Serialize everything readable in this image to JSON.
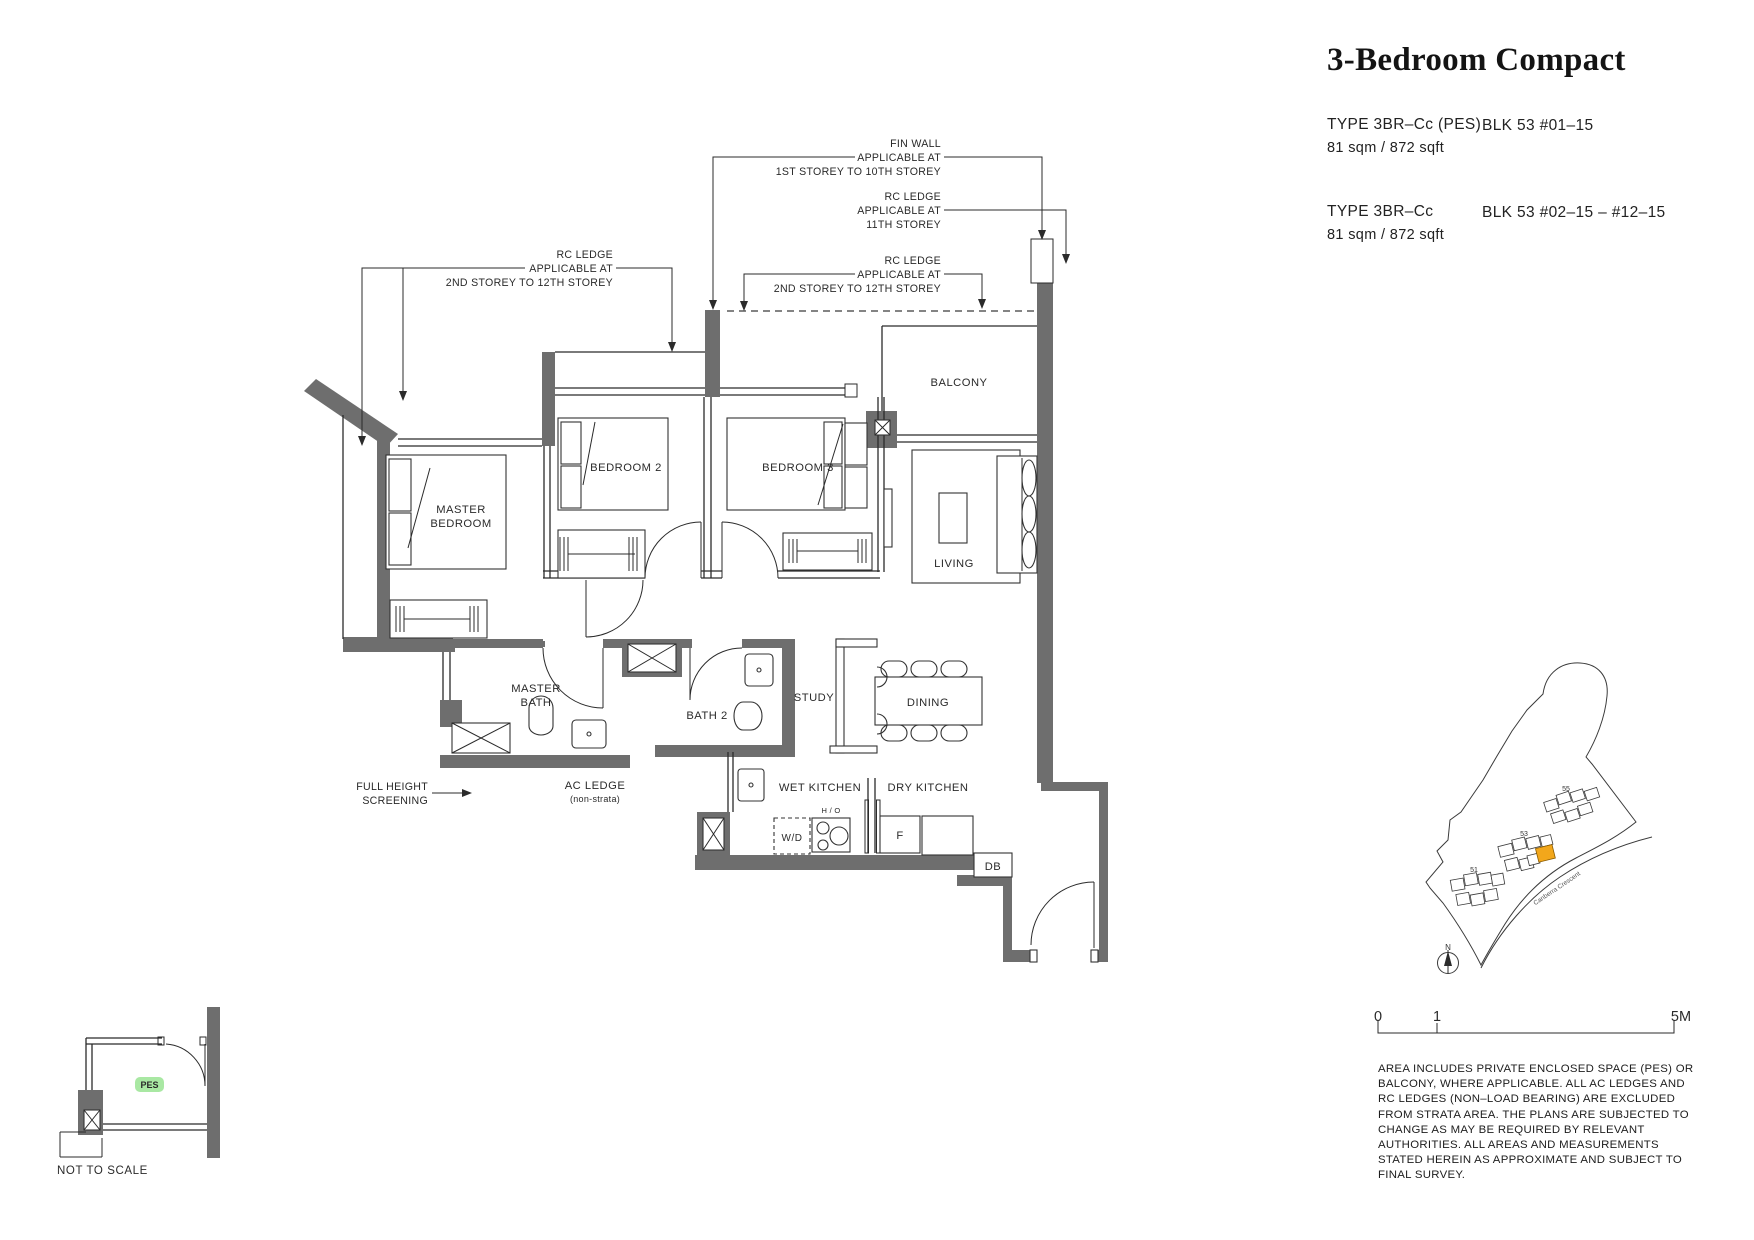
{
  "header": {
    "title": "3-Bedroom Compact",
    "types": [
      {
        "type_label": "TYPE 3BR–Cc (PES)",
        "block": "BLK 53 #01–15",
        "area": "81 sqm / 872 sqft"
      },
      {
        "type_label": "TYPE 3BR–Cc",
        "block": "BLK 53  #02–15 – #12–15",
        "area": "81 sqm / 872 sqft"
      }
    ]
  },
  "plan": {
    "wall_color": "#6e6e6e",
    "rooms": {
      "master_bedroom_l1": "MASTER",
      "master_bedroom_l2": "BEDROOM",
      "bedroom_2": "BEDROOM 2",
      "bedroom_3": "BEDROOM 3",
      "balcony": "BALCONY",
      "living": "LIVING",
      "dining": "DINING",
      "study": "STUDY",
      "master_bath_l1": "MASTER",
      "master_bath_l2": "BATH",
      "bath_2": "BATH 2",
      "wet_kitchen": "WET KITCHEN",
      "dry_kitchen": "DRY KITCHEN",
      "ac_ledge": "AC LEDGE",
      "ac_ledge_note": "(non-strata)"
    },
    "fixtures": {
      "washer_dryer": "W/D",
      "hob": "H / O",
      "fridge": "F",
      "db": "DB"
    },
    "annotations": {
      "fin_wall_l1": "FIN WALL",
      "fin_wall_l2": "APPLICABLE AT",
      "fin_wall_l3": "1ST STOREY TO 10TH  STOREY",
      "rc_ledge_11_l1": "RC LEDGE",
      "rc_ledge_11_l2": "APPLICABLE AT",
      "rc_ledge_11_l3": "11TH STOREY",
      "rc_ledge_right_l1": "RC LEDGE",
      "rc_ledge_right_l2": "APPLICABLE AT",
      "rc_ledge_right_l3": "2ND STOREY TO 12TH  STOREY",
      "rc_ledge_left_l1": "RC LEDGE",
      "rc_ledge_left_l2": "APPLICABLE AT",
      "rc_ledge_left_l3": "2ND STOREY TO 12TH  STOREY",
      "screening_l1": "FULL HEIGHT",
      "screening_l2": "SCREENING"
    }
  },
  "inset": {
    "pes_label": "PES",
    "pes_bg": "#a9e8a3",
    "pes_text_color": "#1d7a26",
    "note": "NOT TO SCALE"
  },
  "site_map": {
    "block_55": "55",
    "block_53": "53",
    "block_51": "51",
    "road": "Canberra Crescent",
    "north": "N",
    "highlight_color": "#F2A71B"
  },
  "scale_bar": {
    "zero": "0",
    "one": "1",
    "five": "5M"
  },
  "disclaimer": {
    "text": "AREA INCLUDES PRIVATE ENCLOSED SPACE (PES) OR BALCONY, WHERE APPLICABLE. ALL AC LEDGES AND RC LEDGES (NON–LOAD BEARING) ARE EXCLUDED FROM STRATA AREA. THE PLANS ARE SUBJECTED TO CHANGE AS MAY BE REQUIRED BY RELEVANT AUTHORITIES. ALL AREAS AND MEASUREMENTS STATED HEREIN AS APPROXIMATE AND SUBJECT TO FINAL SURVEY."
  }
}
